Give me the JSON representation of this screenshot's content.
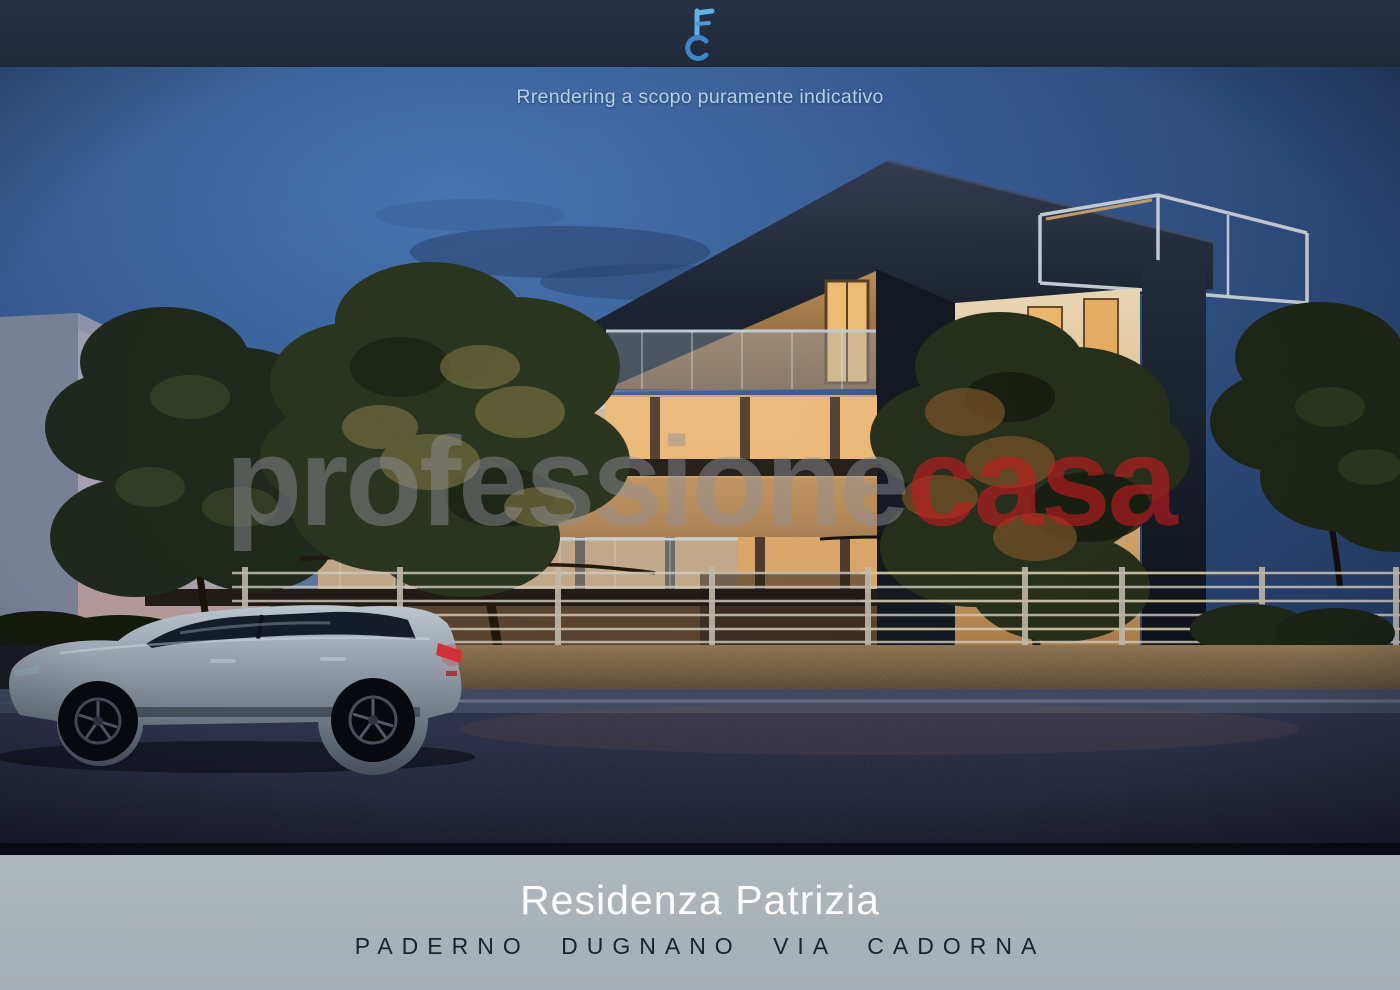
{
  "app": {
    "type": "real-estate-render-flyer"
  },
  "top_bar": {
    "logo_icon": "key-fc-logo"
  },
  "render": {
    "disclaimer": "Rrendering a scopo puramente indicativo",
    "subject": "modern residential building at dusk with silver car in foreground"
  },
  "watermark": {
    "brand_gray": "professione",
    "brand_red": "casa"
  },
  "footer": {
    "title": "Residenza Patrizia",
    "subtitle": "PADERNO DUGNANO VIA CADORNA"
  },
  "colors": {
    "top_bar": "#202c3c",
    "footer_bg": "#a9b2b7",
    "title_text": "#ffffff",
    "subtitle_text": "#18242f",
    "disclaimer_text": "#b7d0ea",
    "watermark_gray": "#919198",
    "watermark_red": "#c41c21",
    "logo_blue_light": "#5fb0e8",
    "logo_blue_dark": "#3c86c8",
    "sky_blue": "#35598f"
  }
}
